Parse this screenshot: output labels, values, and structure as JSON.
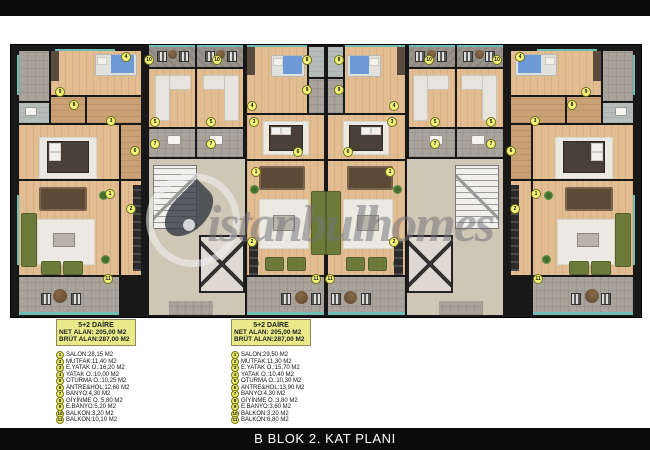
{
  "page": {
    "title": "B BLOK 2. KAT PLANI"
  },
  "watermark": {
    "text": "istanbulhomes"
  },
  "colors": {
    "bar_black": "#0b0b0b",
    "wall_black": "#181818",
    "wood_floor": "#e2bd92",
    "tile_gray": "#a8a49c",
    "glass_teal": "#6fbdb7",
    "sofa_olive": "#6d7b3a",
    "badge_yellow": "#f3f379",
    "infobox_yellow": "#e9e98a"
  },
  "apartments": [
    {
      "header": "5+2  DAİRE",
      "net": "NET ALAN: 205,00 M2",
      "brut": "BRÜT ALAN:287,00 M2",
      "rooms": [
        {
          "num": "1",
          "label": "SALON:28,15 M2"
        },
        {
          "num": "2",
          "label": "MUTFAK:11,40 M2"
        },
        {
          "num": "3",
          "label": "E.YATAK O.:16,20 M2"
        },
        {
          "num": "4",
          "label": "YATAK O.:10,00 M2"
        },
        {
          "num": "5",
          "label": "OTURMA O.:10,25 M2"
        },
        {
          "num": "6",
          "label": "ANTRE&HOL:12,60 M2"
        },
        {
          "num": "7",
          "label": "BANYO:4,30 M2"
        },
        {
          "num": "8",
          "label": "GİYİNME O.:5,80 M2"
        },
        {
          "num": "9",
          "label": "E.BANYO:5,20 M2"
        },
        {
          "num": "10",
          "label": "BALKON:3,20 M2"
        },
        {
          "num": "11",
          "label": "BALKON:10,10 M2"
        }
      ]
    },
    {
      "header": "5+2  DAİRE",
      "net": "NET ALAN: 205,00 M2",
      "brut": "BRÜT ALAN:287,00 M2",
      "rooms": [
        {
          "num": "1",
          "label": "SALON:29,50 M2"
        },
        {
          "num": "2",
          "label": "MUTFAK:11,30 M2"
        },
        {
          "num": "3",
          "label": "E.YATAK O.:15,70 M2"
        },
        {
          "num": "4",
          "label": "YATAK O.:10,40 M2"
        },
        {
          "num": "5",
          "label": "OTURMA O.:10,30 M2"
        },
        {
          "num": "6",
          "label": "ANTRE&HOL:13,90 M2"
        },
        {
          "num": "7",
          "label": "BANYO:4,30 M2"
        },
        {
          "num": "8",
          "label": "GİYİNME O.:3,80 M2"
        },
        {
          "num": "9",
          "label": "E.BANYO:3,60 M2"
        },
        {
          "num": "10",
          "label": "BALKON:3,20 M2"
        },
        {
          "num": "11",
          "label": "BALKON:6,80 M2"
        }
      ]
    }
  ],
  "plan": {
    "badges": [
      {
        "n": "9",
        "x": 44,
        "y": 42
      },
      {
        "n": "8",
        "x": 58,
        "y": 55
      },
      {
        "n": "3",
        "x": 95,
        "y": 71
      },
      {
        "n": "6",
        "x": 119,
        "y": 101
      },
      {
        "n": "1",
        "x": 94,
        "y": 144
      },
      {
        "n": "2",
        "x": 115,
        "y": 159
      },
      {
        "n": "5",
        "x": 139,
        "y": 72
      },
      {
        "n": "7",
        "x": 139,
        "y": 94
      },
      {
        "n": "10",
        "x": 133,
        "y": 10
      },
      {
        "n": "11",
        "x": 92,
        "y": 229
      },
      {
        "n": "4",
        "x": 110,
        "y": 7
      },
      {
        "n": "10",
        "x": 201,
        "y": 10
      },
      {
        "n": "5",
        "x": 195,
        "y": 72
      },
      {
        "n": "7",
        "x": 195,
        "y": 94
      },
      {
        "n": "4",
        "x": 236,
        "y": 56
      },
      {
        "n": "8",
        "x": 291,
        "y": 10
      },
      {
        "n": "9",
        "x": 291,
        "y": 40
      },
      {
        "n": "3",
        "x": 238,
        "y": 72
      },
      {
        "n": "6",
        "x": 282,
        "y": 102
      },
      {
        "n": "1",
        "x": 240,
        "y": 122
      },
      {
        "n": "2",
        "x": 236,
        "y": 192
      },
      {
        "n": "11",
        "x": 300,
        "y": 229
      },
      {
        "n": "10",
        "x": 413,
        "y": 10
      },
      {
        "n": "5",
        "x": 419,
        "y": 72
      },
      {
        "n": "7",
        "x": 419,
        "y": 94
      },
      {
        "n": "4",
        "x": 378,
        "y": 56
      },
      {
        "n": "8",
        "x": 323,
        "y": 10
      },
      {
        "n": "9",
        "x": 323,
        "y": 40
      },
      {
        "n": "3",
        "x": 376,
        "y": 72
      },
      {
        "n": "6",
        "x": 332,
        "y": 102
      },
      {
        "n": "1",
        "x": 374,
        "y": 122
      },
      {
        "n": "2",
        "x": 378,
        "y": 192
      },
      {
        "n": "11",
        "x": 314,
        "y": 229
      },
      {
        "n": "9",
        "x": 570,
        "y": 42
      },
      {
        "n": "8",
        "x": 556,
        "y": 55
      },
      {
        "n": "3",
        "x": 519,
        "y": 71
      },
      {
        "n": "6",
        "x": 495,
        "y": 101
      },
      {
        "n": "1",
        "x": 520,
        "y": 144
      },
      {
        "n": "2",
        "x": 499,
        "y": 159
      },
      {
        "n": "5",
        "x": 475,
        "y": 72
      },
      {
        "n": "7",
        "x": 475,
        "y": 94
      },
      {
        "n": "10",
        "x": 481,
        "y": 10
      },
      {
        "n": "11",
        "x": 522,
        "y": 229
      },
      {
        "n": "4",
        "x": 504,
        "y": 7
      }
    ]
  }
}
